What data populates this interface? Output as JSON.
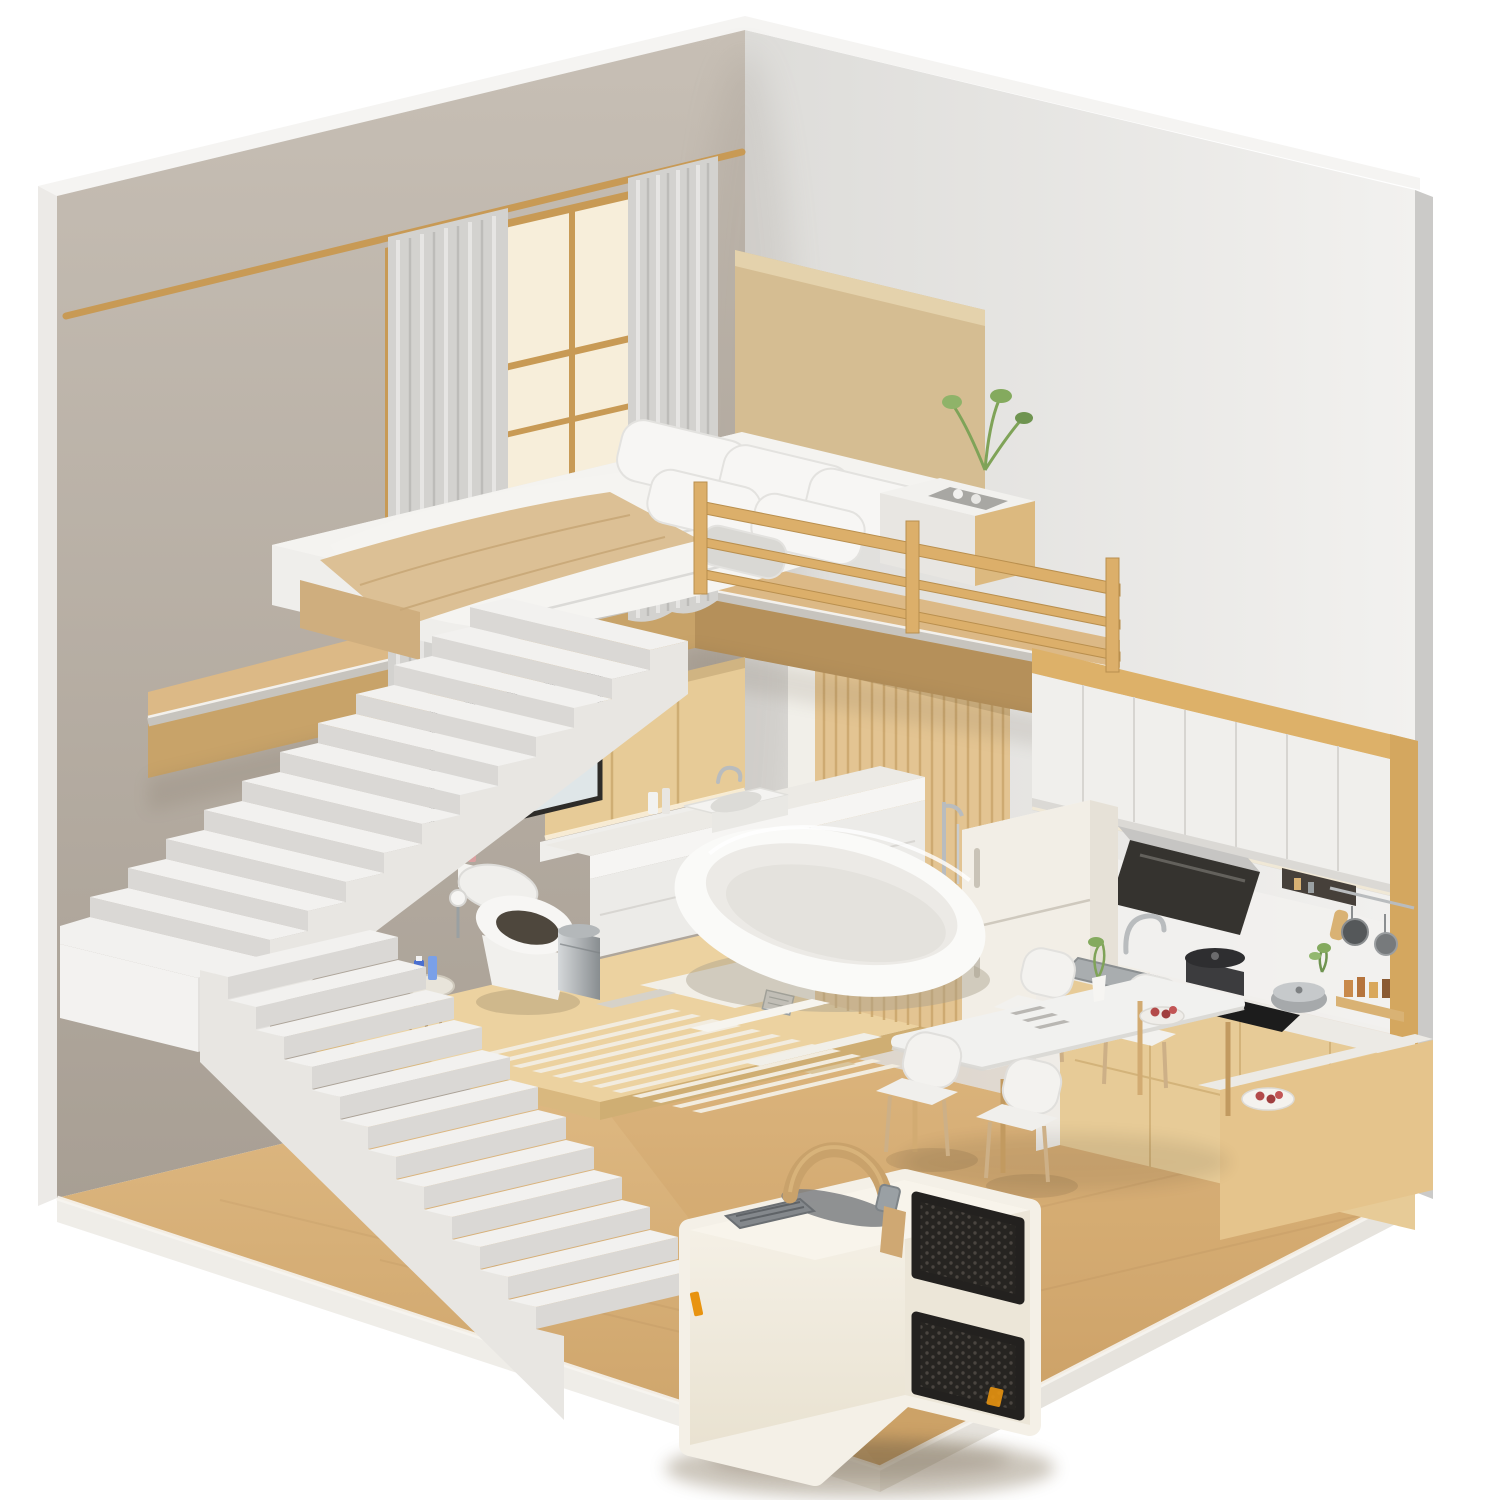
{
  "meta": {
    "type": "3d-isometric-interior-render",
    "subject": "miniature loft apartment cutaway with portable air conditioner in foreground",
    "background": "#ffffff"
  },
  "palette": {
    "background": "#ffffff",
    "wall_left": "#b7aea3",
    "wall_left_light": "#c7bfb5",
    "wall_right": "#e7e6e4",
    "wall_edge": "#f5f4f2",
    "wall_side_edge": "#cbcac8",
    "floor_wood": "#d9b37b",
    "floor_rim": "#efece6",
    "platform_wood": "#ecd2a0",
    "platform_face": "#d9b87f",
    "tile_white": "#f2efe7",
    "mat_slat": "#f2ecdf",
    "loft_wood": "#dcb986",
    "slab_face": "#c8a369",
    "slab_face_dark": "#b5905a",
    "slab_rim": "#c7c4be",
    "stair_top": "#f2f1ef",
    "stair_riser": "#dad8d5",
    "stair_side": "#e8e6e2",
    "railing_wood": "#dcaf6a",
    "frame_wood": "#c89a55",
    "window_glow": "#f7eeda",
    "curtain": "#d3d2cf",
    "headboard": "#d5bd92",
    "bedding": "#f4f3f0",
    "bed_side": "#e7e6e3",
    "blanket": "#dcc095",
    "cabinet_wood": "#e7cb97",
    "cabinet_white": "#f0efec",
    "counter_white": "#eceae5",
    "hood_dark": "#35332f",
    "steel": "#c6c5c3",
    "fridge": "#f2eee6",
    "slat_wood": "#e3c492",
    "fixture_white": "#fafaf8",
    "fixture_inner": "#eceae6",
    "mirror_glass": "#dfe6e8",
    "table_top": "#f1f1ef",
    "chair_white": "#f3f2ef",
    "wood_leg": "#d2ab72",
    "ac_body": "#f4f0e7",
    "ac_body_shade": "#ece6d8",
    "ac_grille": "#2b2926",
    "ac_handle": "#c9a26b",
    "ac_vent": "#84888c",
    "accent_orange": "#e8930f",
    "plant_green": "#84aa5e",
    "fruit_red": "#b34a4a",
    "bottle_blue": "#4a6fd0"
  },
  "scene": {
    "structure": {
      "left_wall": "warm greige plaster with white cut edge",
      "right_wall": "light gray plaster with visible wall thickness",
      "floor": "light oak wood with pale rim",
      "loft_slab": "oak deck with gray trim band"
    },
    "loft_bedroom": {
      "bed": {
        "bedding": "white duvet",
        "blanket": "beige throw",
        "headboard": "tan upholstered panel",
        "pillow_count": 6
      },
      "window": {
        "frame": "wood mullion grid",
        "glow": "warm daylight"
      },
      "curtains": {
        "panels": 2,
        "color_name": "light gray"
      },
      "curtain_rod": "wood pole",
      "nightstand": {
        "top_items": [
          "tray",
          "cups"
        ]
      },
      "plant": "green sprigs",
      "railing": {
        "posts": 3,
        "rails": 3,
        "material": "light oak"
      }
    },
    "bathroom": {
      "mirror": "black framed, reflecting basin",
      "vanity": {
        "basin": "white vessel sink",
        "faucet": "chrome"
      },
      "wardrobe": "oak panel doors over vanity",
      "toilet": "white smart toilet with open lid",
      "side_stool": {
        "bottles": 2,
        "bottle_color": "blue"
      },
      "trash_can": "stainless pedal bin",
      "bathtub": "white freestanding oval",
      "tub_faucet": "chrome floor-mounted",
      "accent_wall": "vertical oak slats",
      "bath_mat": {
        "slats": 12
      },
      "floor_drain": "chrome square",
      "platform": "raised oak deck with white stone inlay"
    },
    "kitchen": {
      "upper_cabinets": {
        "doors": 7,
        "frame": "oak cornice and side panel"
      },
      "range_hood": "black angled glass with steel flap",
      "wall_niche": "recessed dark shelf",
      "utensil_rail": {
        "hanging_pans": 2
      },
      "refrigerator": "cream two-door",
      "sink": "stainless undermount",
      "faucet": "chrome gooseneck",
      "cooktop": {
        "type": "gas",
        "pots": 2
      },
      "spice_rack": "wood shelf with amber bottles",
      "base_cabinets": "oak fronts with white counter",
      "island_counter": "L-return with white top",
      "serving_plate": "red fruit"
    },
    "dining": {
      "table": {
        "top": "white",
        "legs": "oak"
      },
      "chairs": 4,
      "tabletop_items": [
        "cutlery",
        "vase with greenery",
        "fruit bowl"
      ]
    },
    "stairs": {
      "upper_flight_steps": 11,
      "landing": "white platform",
      "lower_flight_steps": 12,
      "material": "white painted concrete"
    },
    "foreground_product": {
      "portable_ac": {
        "body": "cream rounded cube",
        "carry_handle": "tan leather strap with metal buckle",
        "front_grilles": 2,
        "grille_texture": "black honeycomb",
        "top_vent": "gray recessed inlet",
        "accent_badges": {
          "count": 2,
          "color": "#e8930f"
        }
      }
    }
  }
}
